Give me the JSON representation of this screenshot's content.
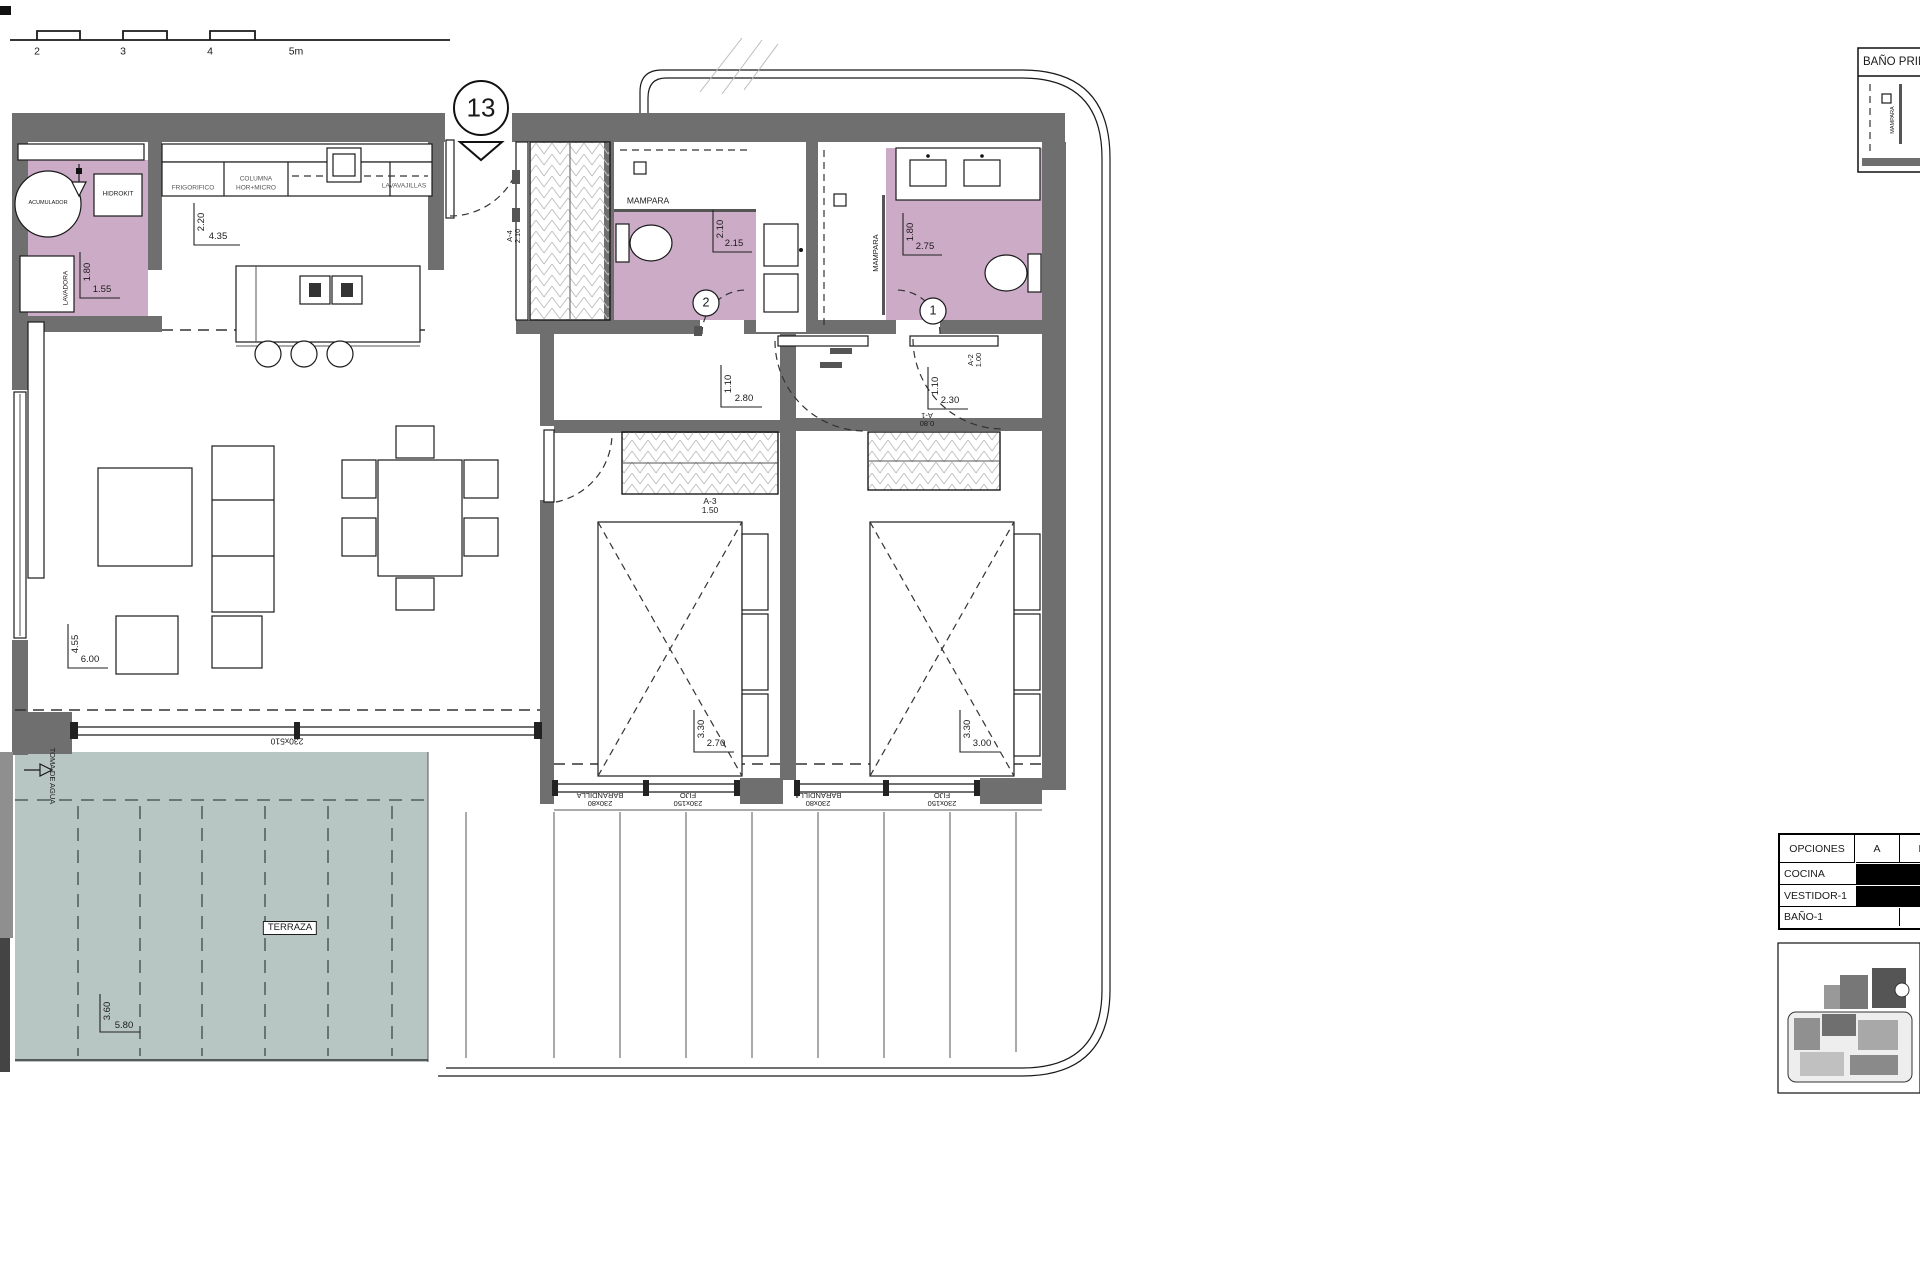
{
  "colors": {
    "wall": "#6f6f6f",
    "wet": "#cbabc6",
    "terrace": "#b8c6c3",
    "line": "#1a1a1a"
  },
  "scale_bar": {
    "t2": "2",
    "t3": "3",
    "t4": "4",
    "t5": "5m"
  },
  "unit": {
    "number": "13"
  },
  "laundry": {
    "acumulador": "ACUMULADOR",
    "hidrokit": "HIDROKIT",
    "lavadora": "LAVADORA",
    "dim_v": "1.80",
    "dim_h": "1.55"
  },
  "kitchen": {
    "frigorifico": "FRIGORIFICO",
    "columna_l1": "COLUMNA",
    "columna_l2": "HOR+MICRO",
    "lavavajillas": "LAVAVAJILLAS",
    "dim_v": "2.20",
    "dim_h": "4.35"
  },
  "entry_closet": {
    "door_code": "A-4",
    "door_size": "2.10"
  },
  "bath2": {
    "number": "2",
    "mampara": "MAMPARA",
    "dim_v": "2.10",
    "dim_h": "2.15"
  },
  "bath1": {
    "number": "1",
    "mampara": "MAMPARA",
    "dim_v": "1.80",
    "dim_h": "2.75"
  },
  "hall": {
    "dim_v": "1.10",
    "dim_h": "2.80"
  },
  "hall2": {
    "dim_v": "1.10",
    "dim_h": "2.30",
    "door_a2_code": "A-2",
    "door_a2_size": "1.00",
    "door_a1_code": "A-1",
    "door_a1_size": "0.80"
  },
  "living": {
    "dim_v": "4.55",
    "dim_h": "6.00"
  },
  "bedroom2": {
    "dim_v": "3.30",
    "dim_h": "2.70",
    "wardrobe_code": "A-3",
    "wardrobe_size": "1.50",
    "win1_size": "230x80",
    "win1_type": "BARANDILLA",
    "win2_size": "230x150",
    "win2_type": "FIJO"
  },
  "bedroom1": {
    "dim_v": "3.30",
    "dim_h": "3.00",
    "win1_size": "230x80",
    "win1_type": "BARANDILLA",
    "win2_size": "230x150",
    "win2_type": "FIJO"
  },
  "terrace": {
    "label": "TERRAZA",
    "dim_v": "3.60",
    "dim_h": "5.80",
    "window_size": "230x510",
    "toma": "TOMA DE AGUA"
  },
  "detail_box": {
    "title": "BAÑO PRIN",
    "mampara": "MAMPARA"
  },
  "options_table": {
    "col_header": "OPCIONES",
    "col_a": "A",
    "col_b": "B",
    "rows": [
      {
        "name": "COCINA",
        "filled": true
      },
      {
        "name": "VESTIDOR-1",
        "filled": true
      },
      {
        "name": "BAÑO-1",
        "filled": false
      }
    ]
  }
}
